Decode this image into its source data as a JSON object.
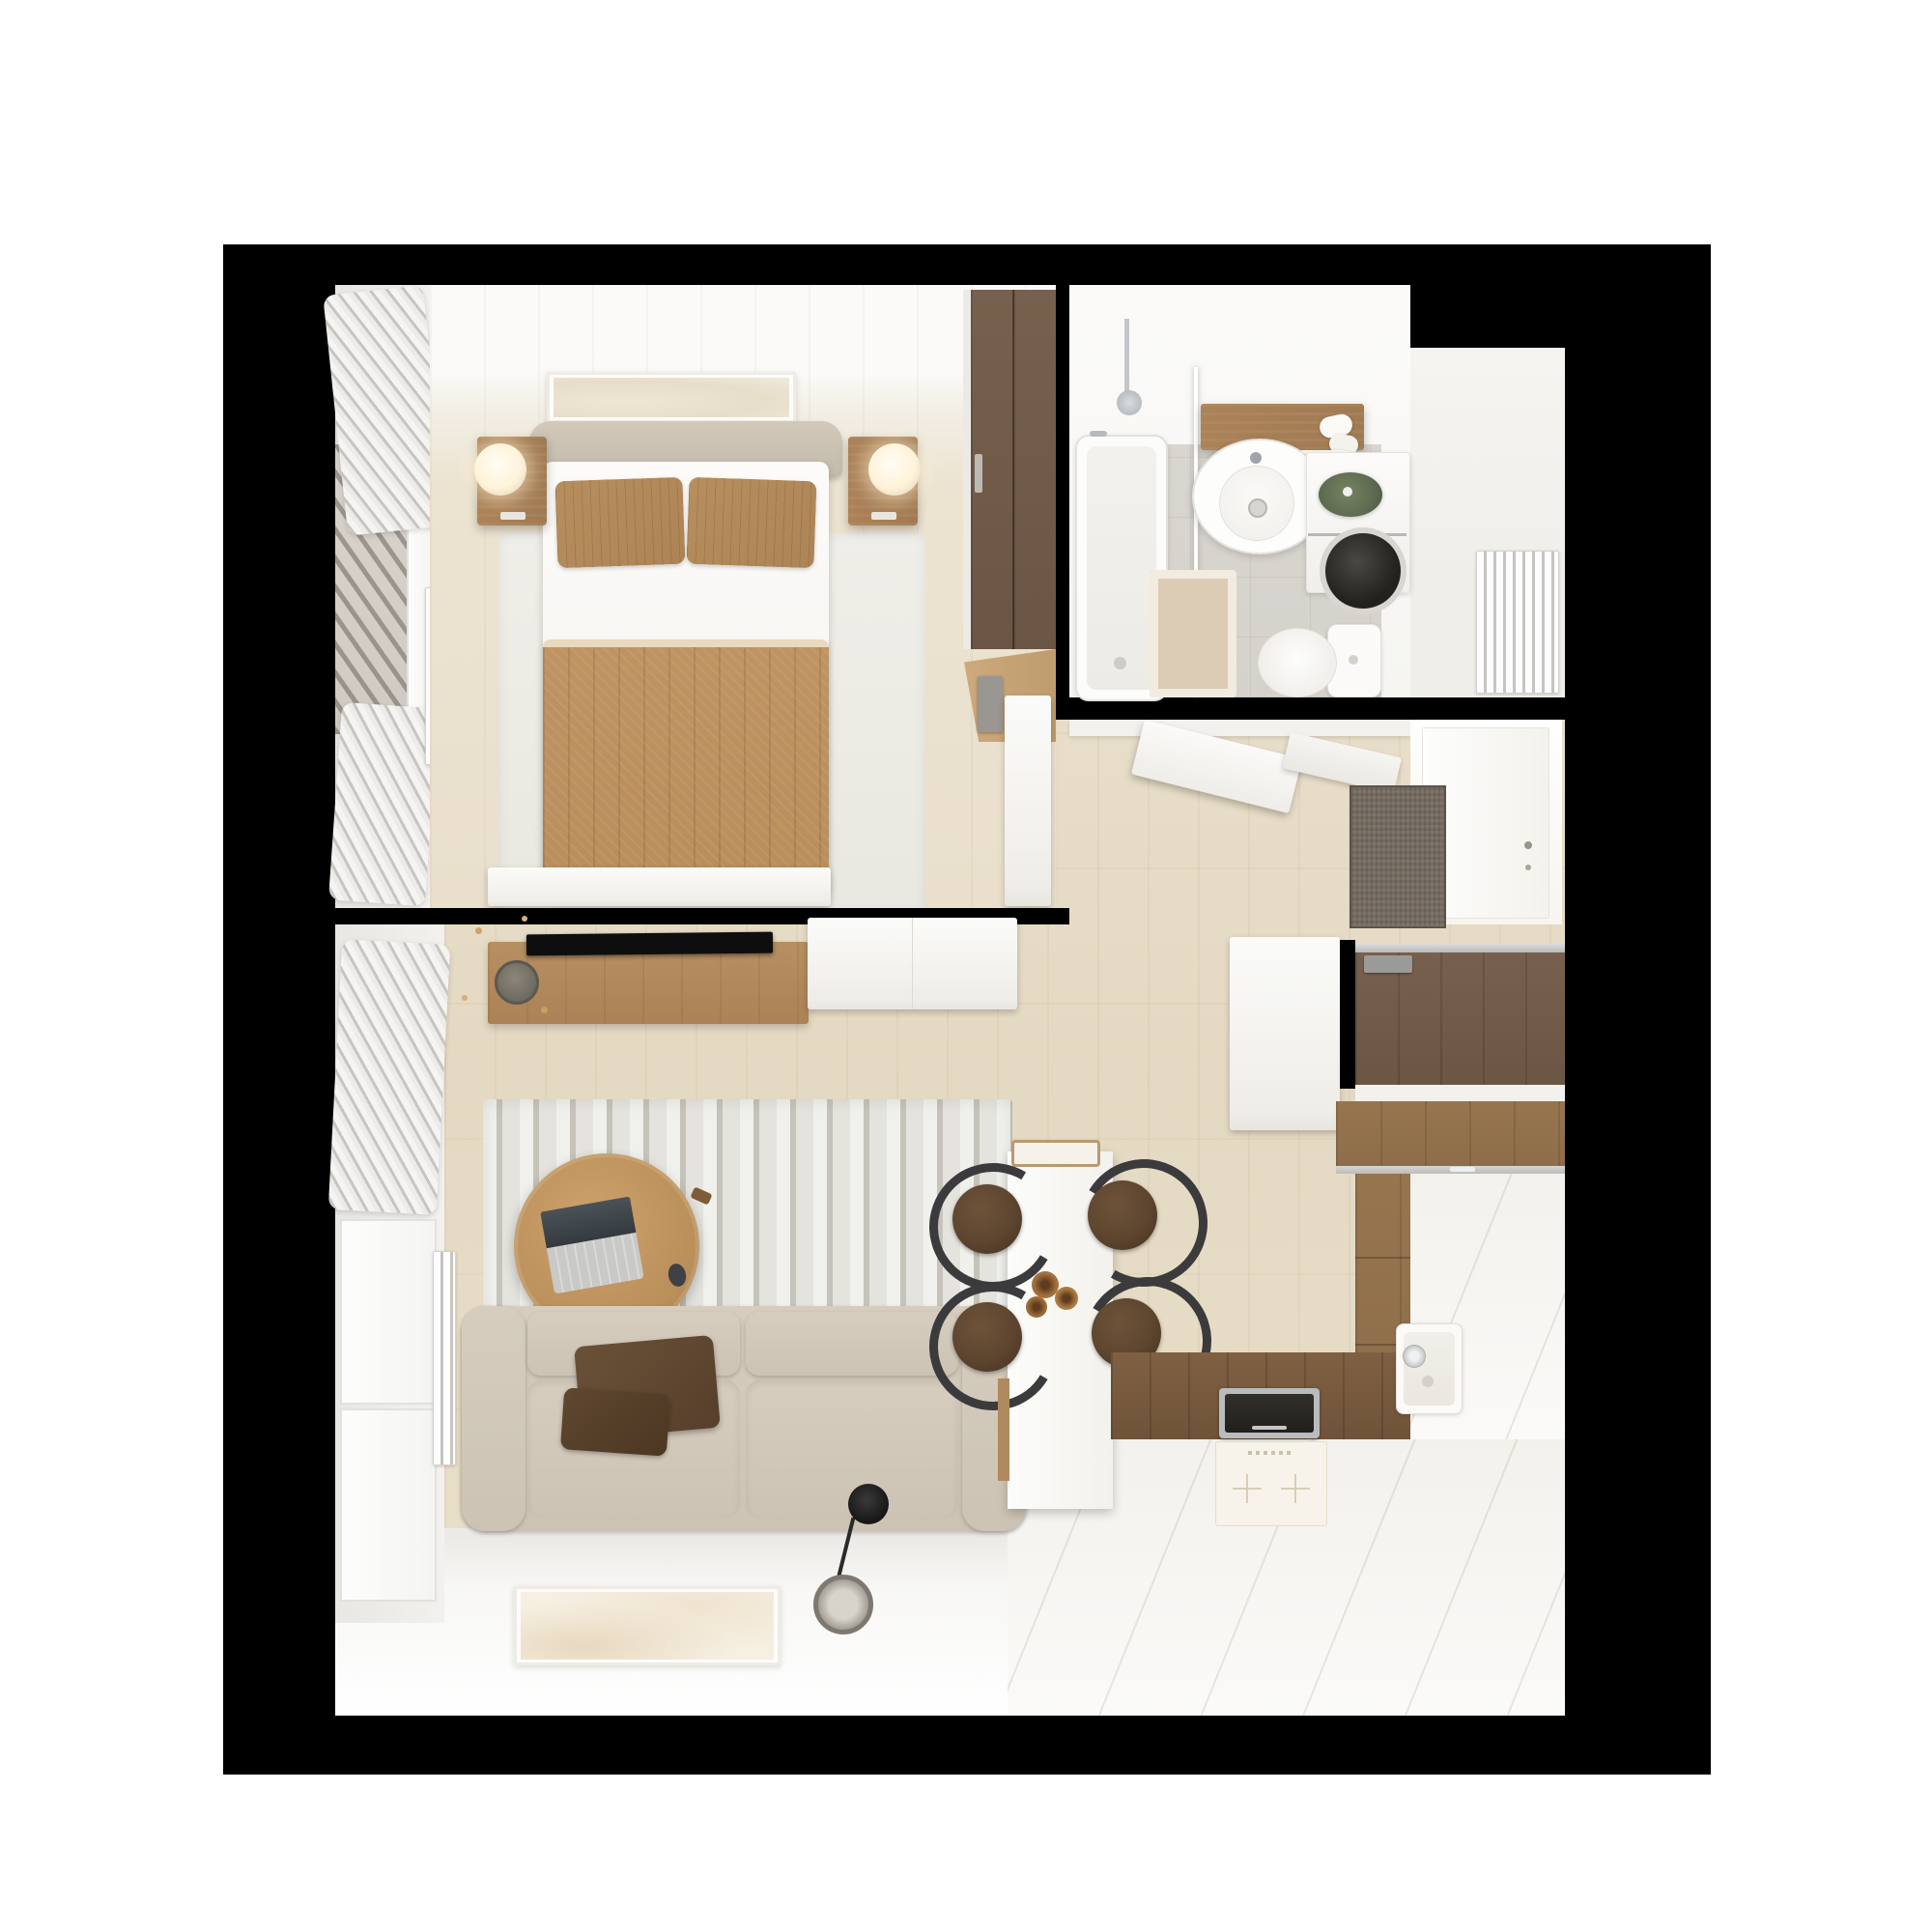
{
  "scene": {
    "kind": "3d-floor-plan-render",
    "view": "top-down",
    "apartment": "studio one-bedroom",
    "visible_text": ""
  },
  "palette": {
    "page-bg": "#ffffff",
    "render-bg": "#000000",
    "floor-wood": "#e8dec9",
    "floor-bed": "#ece3d1",
    "south-white": "#f8f7f5",
    "bath-white": "#f6f5f2",
    "tile": "#d9d6d0",
    "niche": "#f0eee8",
    "wood-mid": "#ac8257",
    "wood-dark": "#6b5544",
    "kitchen-wood": "#8d6c4a",
    "duvet": "#b98e5b",
    "pillow": "#ad8455",
    "sofa": "#ccc3b4",
    "chair-seat": "#5d452f",
    "metal": "#3b3b3d",
    "doormat": "#746a5f",
    "lamp-glow": "#fff3da",
    "plant": "#5f6b51"
  },
  "rooms": [
    {
      "name": "bedroom",
      "items": [
        "double-bed",
        "headboard",
        "pillow-left",
        "pillow-right",
        "duvet",
        "bed-rug",
        "nightstand-left",
        "nightstand-right",
        "sphere-lamp-left",
        "sphere-lamp-right",
        "wardrobe",
        "wardrobe-shelf",
        "open-door-leaf",
        "low-dresser",
        "wall-art",
        "window",
        "curtains",
        "radiator"
      ]
    },
    {
      "name": "bathroom",
      "items": [
        "bathtub",
        "shower-set",
        "glass-screen",
        "vanity-shelf",
        "towels",
        "mirror",
        "round-sink",
        "washing-machine",
        "plant",
        "toilet",
        "bath-mat",
        "tile-floor"
      ]
    },
    {
      "name": "entry-hall",
      "items": [
        "bathroom-door-leaf",
        "door-frame",
        "front-door",
        "doormat",
        "entry-wardrobe",
        "door-closer",
        "sliding-panel",
        "wall-stub"
      ]
    },
    {
      "name": "niche",
      "items": [
        "radiator"
      ]
    },
    {
      "name": "living-room",
      "items": [
        "tv-console",
        "tv",
        "vase-with-sprigs",
        "sideboard",
        "striped-rug",
        "coffee-table",
        "laptop",
        "mouse",
        "sofa",
        "throw-blanket",
        "floor-lamp",
        "leaning-artwork",
        "window",
        "curtains",
        "radiator"
      ]
    },
    {
      "name": "dining",
      "items": [
        "bar-table",
        "serving-tray",
        "dried-flowers",
        "chair-left-top",
        "chair-left-bottom",
        "chair-right-top",
        "chair-right-bottom"
      ]
    },
    {
      "name": "kitchen",
      "items": [
        "wood-worktop",
        "induction-hob",
        "cooktop-front-panel",
        "sink",
        "faucet",
        "upper-cabinet-slab",
        "tall-cabinet-front",
        "counter-white-bottom",
        "counter-white-right"
      ]
    }
  ]
}
